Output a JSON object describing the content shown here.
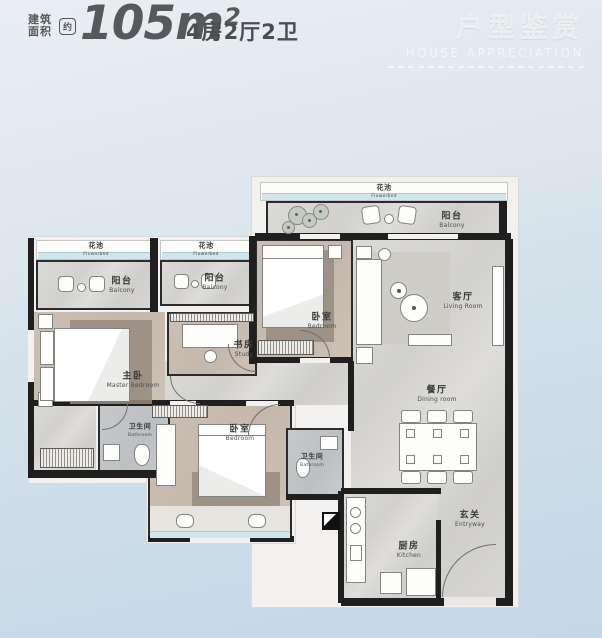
{
  "header": {
    "area_label_line1": "建筑",
    "area_label_line2": "面积",
    "approx_badge": "约",
    "area_value": "105m",
    "area_exponent": "2",
    "layout_text": "4房2厅2卫",
    "watermark_title": "户型鉴赏",
    "watermark_subtitle": "HOUSE APPRECIATION"
  },
  "rooms": {
    "flowerbed": {
      "zh": "花池",
      "en": "Flowerbed"
    },
    "balcony": {
      "zh": "阳台",
      "en": "Balcony"
    },
    "living_room": {
      "zh": "客厅",
      "en": "Living Room"
    },
    "dining_room": {
      "zh": "餐厅",
      "en": "Dining room"
    },
    "entryway": {
      "zh": "玄关",
      "en": "Entryway"
    },
    "kitchen": {
      "zh": "厨房",
      "en": "Kitchen"
    },
    "master_bedroom": {
      "zh": "主卧",
      "en": "Master Bedroom"
    },
    "study": {
      "zh": "书房",
      "en": "Study"
    },
    "bedroom": {
      "zh": "卧室",
      "en": "Bedroom"
    },
    "bathroom": {
      "zh": "卫生间",
      "en": "Bathroom"
    }
  },
  "colors": {
    "background_top": "#eaeef2",
    "background_bottom": "#c3d7e7",
    "wall": "#1f1f1f",
    "bedroom_floor": "#c8bcb0",
    "public_floor": "#d6d5d2",
    "flowerbed_accent": "#cfe6ea",
    "header_text": "#57585a",
    "watermark_text": "rgba(255,255,255,0.55)"
  }
}
